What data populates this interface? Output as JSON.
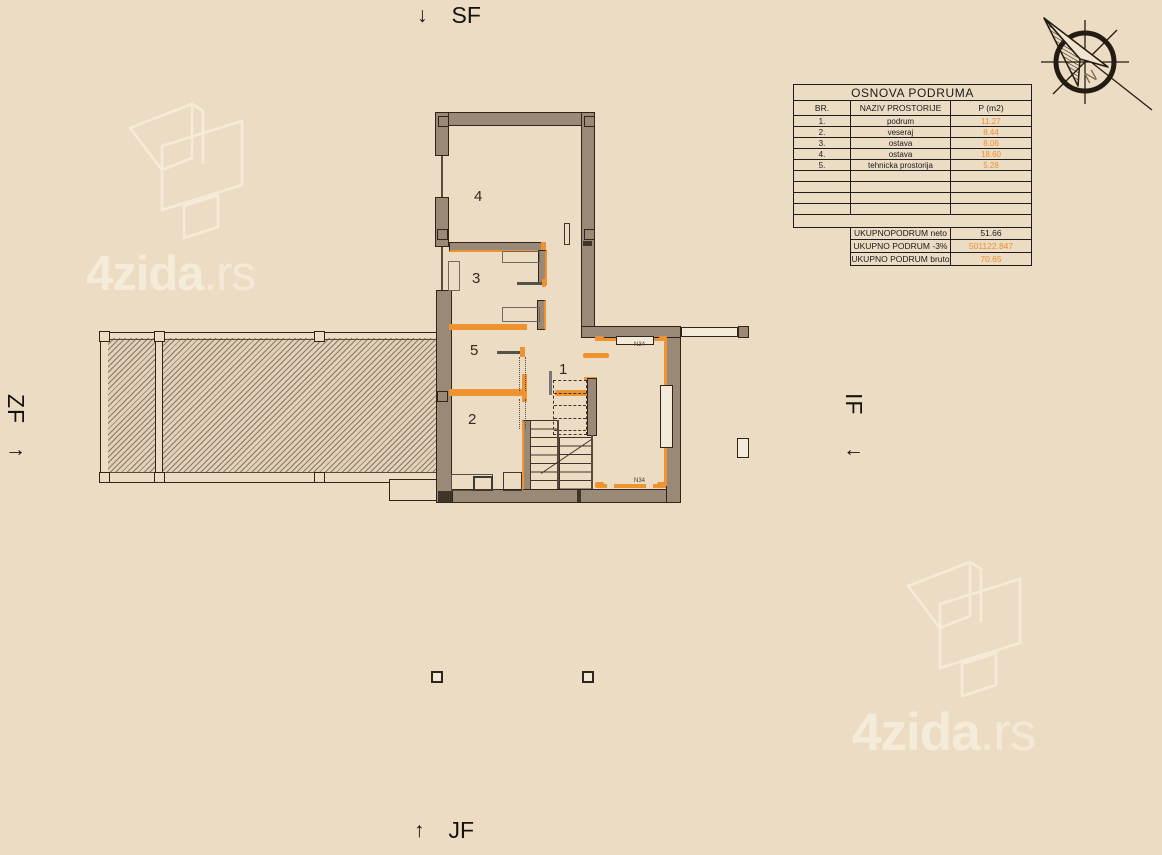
{
  "directions": {
    "top": {
      "arrow": "↓",
      "label": "SF"
    },
    "bottom": {
      "arrow": "↑",
      "label": "JF"
    },
    "left": {
      "arrow": "→",
      "label": "ZF"
    },
    "right": {
      "arrow": "←",
      "label": "IF"
    }
  },
  "compass": {
    "letter": "N"
  },
  "watermark": {
    "bold": "4zida",
    "light": ".rs"
  },
  "table": {
    "title": "OSNOVA PODRUMA",
    "headers": [
      "BR.",
      "NAZIV PROSTORIJE",
      "P (m2)"
    ],
    "rows": [
      {
        "br": "1.",
        "name": "podrum",
        "area": "11.27"
      },
      {
        "br": "2.",
        "name": "veseraj",
        "area": "8.44"
      },
      {
        "br": "3.",
        "name": "ostava",
        "area": "8.06"
      },
      {
        "br": "4.",
        "name": "ostava",
        "area": "18.60"
      },
      {
        "br": "5.",
        "name": "tehnicka prostorija",
        "area": "5.28"
      }
    ],
    "summary": [
      {
        "label": "UKUPNOPODRUM neto",
        "value": "51.66"
      },
      {
        "label": "UKUPNO PODRUM -3%",
        "value": "501122.847"
      },
      {
        "label": "UKUPNO PODRUM bruto",
        "value": "70.65"
      }
    ]
  },
  "plan": {
    "rooms": [
      {
        "number": "1"
      },
      {
        "number": "2"
      },
      {
        "number": "3"
      },
      {
        "number": "4"
      },
      {
        "number": "5"
      }
    ],
    "window_labels": [
      "N34",
      "N34"
    ]
  },
  "colors": {
    "background": "#eddcc4",
    "wall": "#9a8976",
    "outline": "#2f2619",
    "accent_orange": "#ef9330",
    "table_value_orange": "#e98f2e",
    "watermark": "#f6ecdb"
  }
}
